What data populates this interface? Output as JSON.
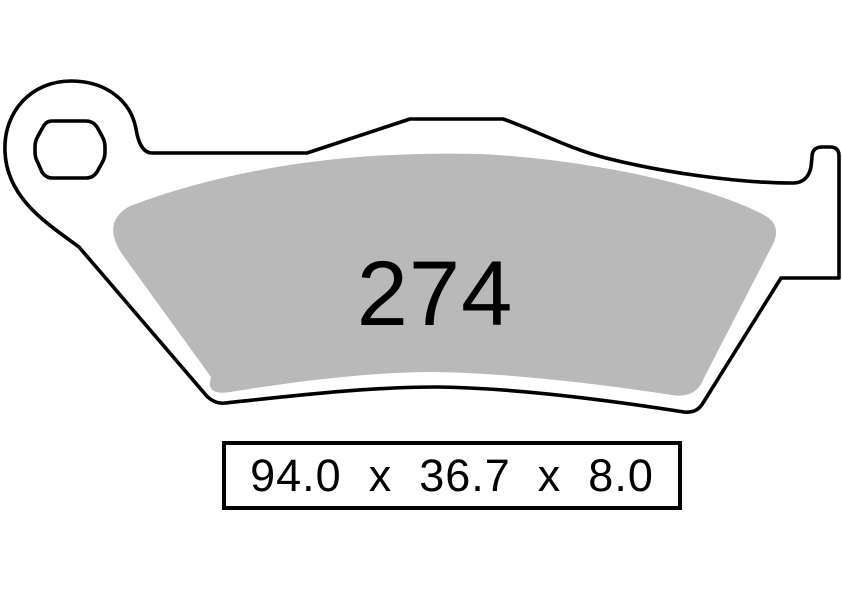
{
  "pad": {
    "number": "274",
    "dimensions_label": "94.0  x  36.7  x  8.0",
    "width_mm": "94.0",
    "height_mm": "36.7",
    "thickness_mm": "8.0",
    "dimension_separator": "x"
  },
  "colors": {
    "outline": "#000000",
    "backplate_fill": "#ffffff",
    "friction_fill": "#b9b9b9",
    "background": "#ffffff"
  }
}
